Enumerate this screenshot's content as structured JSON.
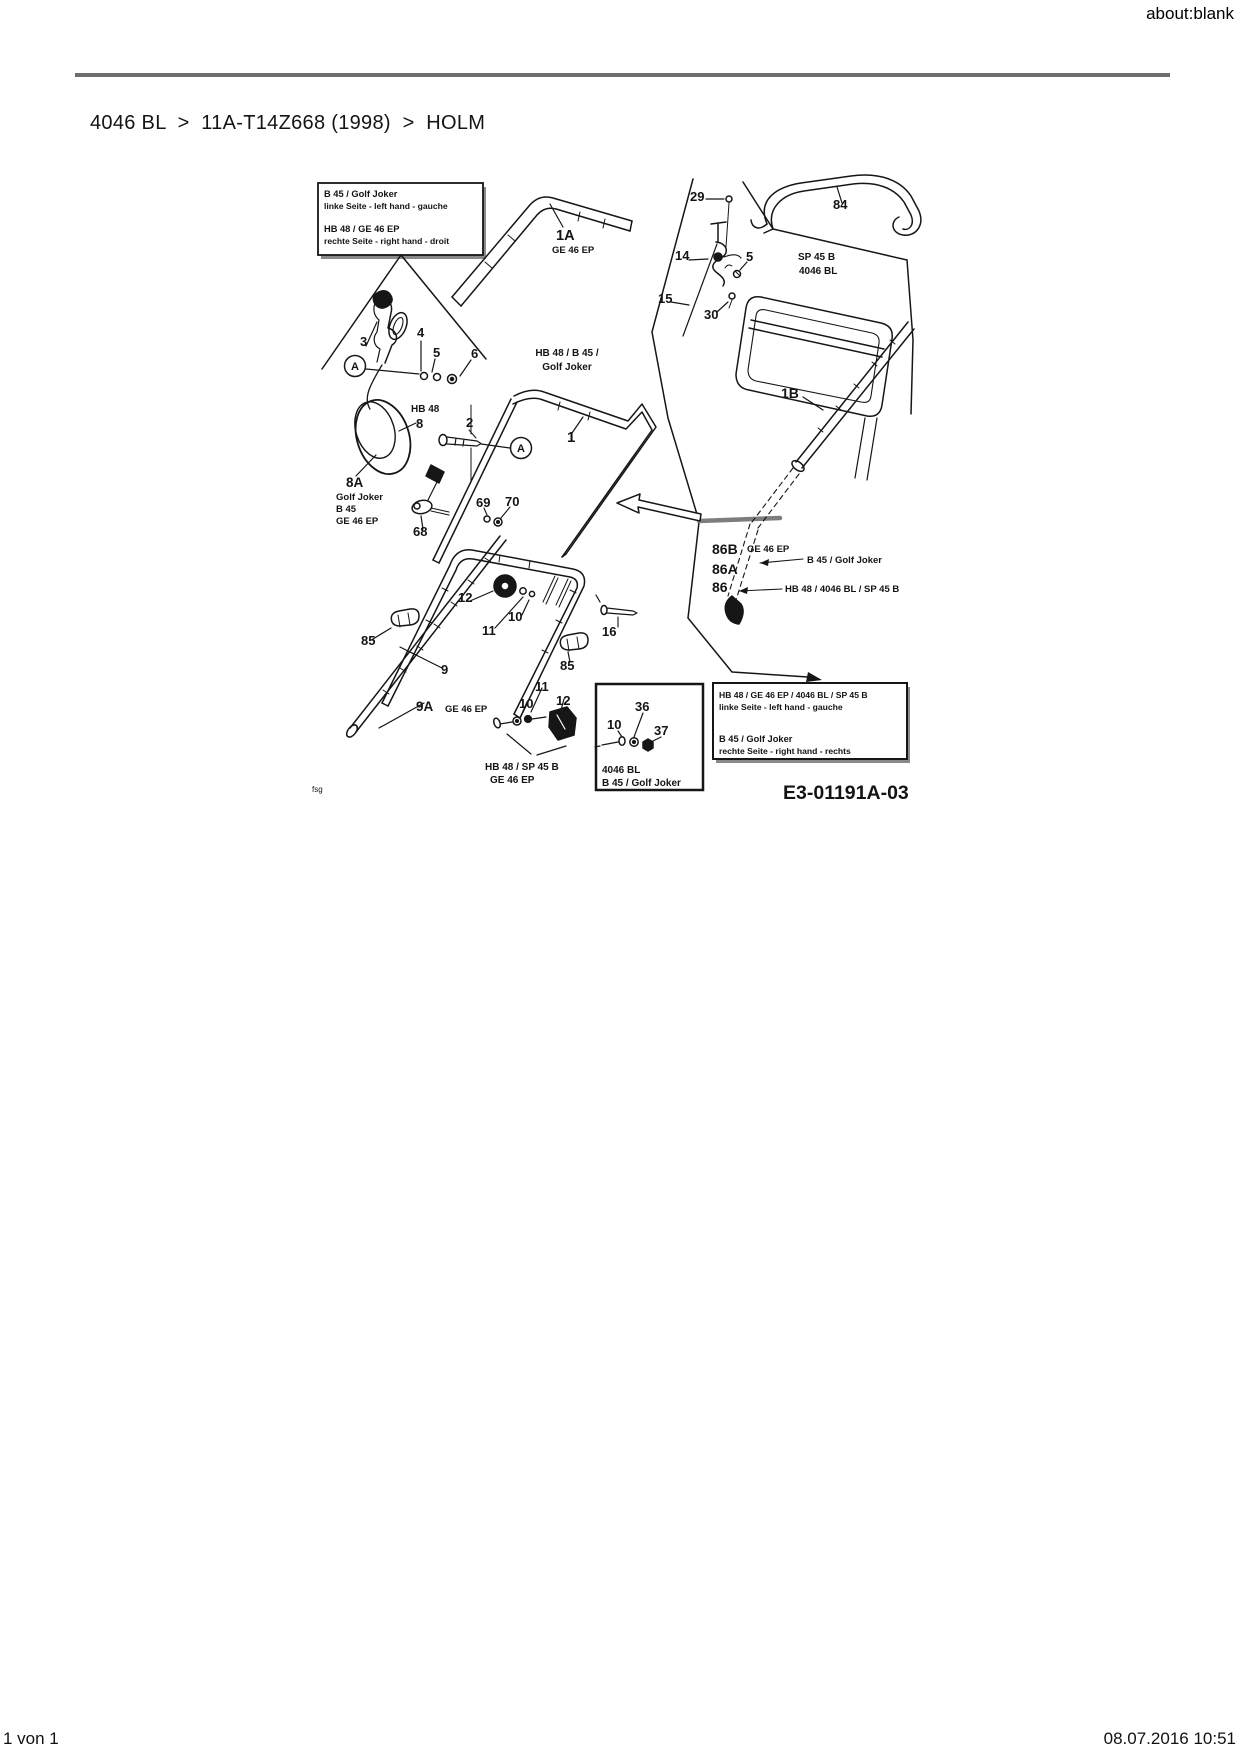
{
  "page": {
    "url_header": "about:blank",
    "breadcrumb": "4046 BL  >  11A-T14Z668 (1998)  >  HOLM",
    "footer_left": "1 von 1",
    "footer_right": "08.07.2016 10:51"
  },
  "colors": {
    "divider": "#6e6e6e",
    "ink": "#161616"
  },
  "diagram": {
    "drawing_number": "E3-01191A-03",
    "labels": [
      {
        "name": "infobox-left-line-1",
        "text": "B 45 / Golf Joker",
        "x": 44,
        "y": 47,
        "s": 9.3
      },
      {
        "name": "infobox-left-line-2",
        "text": "linke Seite - left hand - gauche",
        "x": 44,
        "y": 59,
        "s": 8.6
      },
      {
        "name": "infobox-left-line-3",
        "text": "HB 48 / GE 46 EP",
        "x": 44,
        "y": 82,
        "s": 9.3
      },
      {
        "name": "infobox-left-line-4",
        "text": "rechte Seite - right hand - droit",
        "x": 44,
        "y": 94,
        "s": 8.6
      },
      {
        "name": "part-label-3",
        "text": "3",
        "x": 80,
        "y": 196
      },
      {
        "name": "part-label-4",
        "text": "4",
        "x": 137,
        "y": 187
      },
      {
        "name": "part-label-5-left",
        "text": "5",
        "x": 153,
        "y": 207
      },
      {
        "name": "part-label-6",
        "text": "6",
        "x": 191,
        "y": 208
      },
      {
        "name": "detail-marker-a-left",
        "text": "A",
        "x": 75,
        "y": 220,
        "s": 11,
        "a": "middle"
      },
      {
        "name": "model-label-hb48",
        "text": "HB 48",
        "x": 131,
        "y": 262,
        "s": 10
      },
      {
        "name": "part-label-8",
        "text": "8",
        "x": 136,
        "y": 278
      },
      {
        "name": "part-label-8a",
        "text": "8A",
        "x": 66,
        "y": 337,
        "s": 13.5
      },
      {
        "name": "model-label-golf-joker-8a",
        "text": "Golf Joker",
        "x": 56,
        "y": 350,
        "s": 9.5
      },
      {
        "name": "model-label-b45-8a",
        "text": "B 45",
        "x": 56,
        "y": 362,
        "s": 9.5
      },
      {
        "name": "model-label-ge46ep-8a",
        "text": "GE 46 EP",
        "x": 56,
        "y": 374,
        "s": 9.5
      },
      {
        "name": "part-label-1a",
        "text": "1A",
        "x": 276,
        "y": 90,
        "s": 14.5
      },
      {
        "name": "model-label-ge46ep-1a",
        "text": "GE 46 EP",
        "x": 272,
        "y": 103,
        "s": 9.5
      },
      {
        "name": "part-label-2",
        "text": "2",
        "x": 186,
        "y": 277
      },
      {
        "name": "detail-marker-a-right",
        "text": "A",
        "x": 241,
        "y": 302,
        "s": 11,
        "a": "middle"
      },
      {
        "name": "part-label-1",
        "text": "1",
        "x": 287,
        "y": 292,
        "s": 15
      },
      {
        "name": "part-label-29",
        "text": "29",
        "x": 410,
        "y": 51
      },
      {
        "name": "part-label-14",
        "text": "14",
        "x": 395,
        "y": 110
      },
      {
        "name": "part-label-5-right",
        "text": "5",
        "x": 466,
        "y": 111
      },
      {
        "name": "part-label-15",
        "text": "15",
        "x": 378,
        "y": 153
      },
      {
        "name": "part-label-30",
        "text": "30",
        "x": 424,
        "y": 169
      },
      {
        "name": "part-label-84",
        "text": "84",
        "x": 553,
        "y": 59
      },
      {
        "name": "model-label-sp45b",
        "text": "SP 45 B",
        "x": 518,
        "y": 110,
        "s": 10
      },
      {
        "name": "model-label-4046bl",
        "text": "4046 BL",
        "x": 519,
        "y": 124,
        "s": 10
      },
      {
        "name": "model-label-hb48-b45",
        "text": "HB 48 / B 45 /",
        "x": 287,
        "y": 206,
        "s": 10,
        "a": "middle"
      },
      {
        "name": "model-label-golf-joker-center",
        "text": "Golf Joker",
        "x": 287,
        "y": 220,
        "s": 10,
        "a": "middle"
      },
      {
        "name": "part-label-1b",
        "text": "1B",
        "x": 501,
        "y": 248,
        "s": 14
      },
      {
        "name": "part-label-69",
        "text": "69",
        "x": 196,
        "y": 357
      },
      {
        "name": "part-label-70",
        "text": "70",
        "x": 225,
        "y": 356
      },
      {
        "name": "part-label-68",
        "text": "68",
        "x": 133,
        "y": 386
      },
      {
        "name": "part-label-12-upper",
        "text": "12",
        "x": 178,
        "y": 452
      },
      {
        "name": "part-label-10-upper",
        "text": "10",
        "x": 228,
        "y": 471
      },
      {
        "name": "part-label-11-upper",
        "text": "11",
        "x": 202,
        "y": 485
      },
      {
        "name": "part-label-85-left",
        "text": "85",
        "x": 81,
        "y": 495
      },
      {
        "name": "part-label-16",
        "text": "16",
        "x": 322,
        "y": 486
      },
      {
        "name": "part-label-85-right",
        "text": "85",
        "x": 280,
        "y": 520
      },
      {
        "name": "part-label-9",
        "text": "9",
        "x": 161,
        "y": 524
      },
      {
        "name": "part-label-9a",
        "text": "9A",
        "x": 136,
        "y": 561,
        "s": 13.5
      },
      {
        "name": "model-label-ge46ep-9a",
        "text": "GE 46 EP",
        "x": 165,
        "y": 562,
        "s": 9.5
      },
      {
        "name": "part-label-11-lower",
        "text": "11",
        "x": 255,
        "y": 541
      },
      {
        "name": "part-label-10-lower",
        "text": "10",
        "x": 239,
        "y": 558
      },
      {
        "name": "part-label-12-lower",
        "text": "12",
        "x": 276,
        "y": 555
      },
      {
        "name": "model-label-hb48-sp45b",
        "text": "HB 48 / SP 45 B",
        "x": 205,
        "y": 620,
        "s": 10
      },
      {
        "name": "model-label-ge46ep-lower",
        "text": "GE 46 EP",
        "x": 210,
        "y": 633,
        "s": 10
      },
      {
        "name": "part-label-36",
        "text": "36",
        "x": 355,
        "y": 561
      },
      {
        "name": "part-label-10-inset",
        "text": "10",
        "x": 327,
        "y": 579
      },
      {
        "name": "part-label-37",
        "text": "37",
        "x": 374,
        "y": 585
      },
      {
        "name": "model-label-4046bl-inset",
        "text": "4046 BL",
        "x": 322,
        "y": 623,
        "s": 10
      },
      {
        "name": "model-label-b45-golf-joker-inset",
        "text": "B 45 / Golf Joker",
        "x": 322,
        "y": 636,
        "s": 10
      },
      {
        "name": "part-label-86b",
        "text": "86B",
        "x": 432,
        "y": 404,
        "s": 14
      },
      {
        "name": "model-label-ge46ep-86b",
        "text": "GE 46 EP",
        "x": 467,
        "y": 402,
        "s": 9.5
      },
      {
        "name": "part-label-86a",
        "text": "86A",
        "x": 432,
        "y": 424,
        "s": 14
      },
      {
        "name": "model-label-b45-golf-joker-86a",
        "text": "B 45 / Golf Joker",
        "x": 527,
        "y": 413,
        "s": 9.5
      },
      {
        "name": "part-label-86",
        "text": "86",
        "x": 432,
        "y": 442,
        "s": 14
      },
      {
        "name": "model-label-hb48-4046bl-sp45b-86",
        "text": "HB 48 / 4046 BL / SP 45 B",
        "x": 505,
        "y": 442,
        "s": 9.5
      },
      {
        "name": "infobox-right-line-1",
        "text": "HB 48 / GE 46 EP / 4046 BL / SP 45 B",
        "x": 439,
        "y": 548,
        "s": 8.6
      },
      {
        "name": "infobox-right-line-2",
        "text": "linke Seite - left hand - gauche",
        "x": 439,
        "y": 560,
        "s": 8.6
      },
      {
        "name": "infobox-right-line-3",
        "text": "B 45 / Golf Joker",
        "x": 439,
        "y": 592,
        "s": 9.3
      },
      {
        "name": "infobox-right-line-4",
        "text": "rechte Seite - right hand - rechts",
        "x": 439,
        "y": 604,
        "s": 8.6
      },
      {
        "name": "drawing-number",
        "text": "E3-01191A-03",
        "x": 503,
        "y": 649,
        "s": 19.5
      },
      {
        "name": "watermark-fsg",
        "text": "fsg",
        "x": 32,
        "y": 642,
        "s": 8,
        "w": "normal"
      }
    ]
  }
}
